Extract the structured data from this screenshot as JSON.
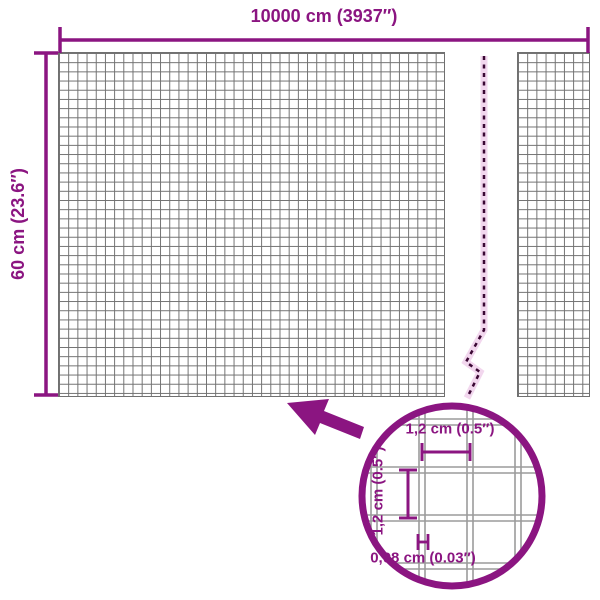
{
  "diagram": {
    "kind": "mesh-panel-dimension-diagram"
  },
  "dimensions": {
    "width": {
      "label": "10000 cm (3937″)"
    },
    "height": {
      "label": "60 cm (23.6″)"
    }
  },
  "magnifier": {
    "mesh_width_label": "1,2 cm (0.5″)",
    "mesh_height_label": "1,2 cm (0.5″)",
    "wire_thickness_label": "0,08 cm (0.03″)"
  },
  "icons": {
    "pointer": "arrow-up-left-icon",
    "callout": "magnifier-circle",
    "break": "break-dashed-line"
  },
  "colors": {
    "accent": "#8B1581",
    "grid_line": "#707070",
    "mesh_wire": "#9B9B9B",
    "dash_line": "#3B0834",
    "dash_halo": "#F2D7EE",
    "background": "#FFFFFF"
  }
}
